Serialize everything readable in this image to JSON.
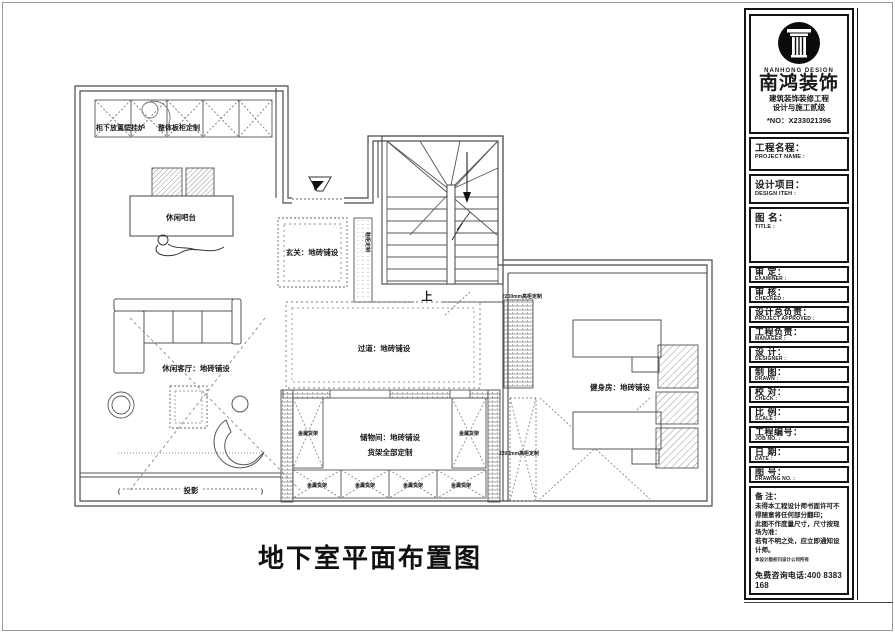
{
  "sheet": {
    "title": "地下室平面布置图"
  },
  "plan": {
    "bar_area": {
      "cabinet_note_left": "柜下放置壁挂炉",
      "cabinet_note_right": "整体板柜定制",
      "bar_label": "休闲吧台"
    },
    "entry": {
      "label": "玄关：地砖铺设",
      "shoe_cabinet_label": "鞋柜定制"
    },
    "stair": {
      "up_label": "上"
    },
    "corridor": {
      "label": "过道：地砖铺设",
      "tall_cabinet_label": "2200mm高柜定制"
    },
    "living": {
      "label": "休闲客厅：地砖铺设",
      "projection_label": "投影",
      "bracket_left": "(",
      "bracket_right": ")"
    },
    "storage": {
      "label_line1": "储物间：地砖铺设",
      "label_line2": "货架全部定制",
      "shelf_label": "金属货架",
      "tall_cabinet_label": "2200mm高柜定制"
    },
    "gym": {
      "label": "健身房：地砖铺设"
    }
  },
  "titleblock": {
    "logo": {
      "en": "NANHONG DESIGN",
      "cn": "南鸿装饰",
      "line1": "建筑装饰装修工程",
      "line2": "设计与施工贰级",
      "license_no": "*NO：X233021396"
    },
    "rows": [
      {
        "cn": "工程名程：",
        "en": "PROJECT NAME :"
      },
      {
        "cn": "设计项目：",
        "en": "DESIGN ITEH :"
      },
      {
        "cn": "图 名：",
        "en": "TITLE :"
      },
      {
        "cn": "审 定：",
        "en": "EXAMINER :"
      },
      {
        "cn": "审 核：",
        "en": "CHECKED :"
      },
      {
        "cn": "设计总负责：",
        "en": "PROJECT APPROVED :"
      },
      {
        "cn": "工程负责：",
        "en": "MANAGER :"
      },
      {
        "cn": "设 计：",
        "en": "DESIGNER :"
      },
      {
        "cn": "制 图：",
        "en": "DRAWN :"
      },
      {
        "cn": "校 对：",
        "en": "CHECK :"
      },
      {
        "cn": "比 例：",
        "en": "SCALE :"
      },
      {
        "cn": "工程编号：",
        "en": "JOB NO. :"
      },
      {
        "cn": "日 期：",
        "en": "DATE :"
      },
      {
        "cn": "图 号：",
        "en": "DRAWING NO. :"
      }
    ],
    "remarks": {
      "title": "备 注：",
      "lines": [
        "未得本工程设计师书面许可不得随意将任何部分翻印；",
        "此图不作度量尺寸，尺寸按现场为准：",
        "若有不明之处，应立即通知设计师。",
        "本设计版权归设计公司所有"
      ],
      "phone": "免费咨询电话:400 8383 168"
    }
  }
}
